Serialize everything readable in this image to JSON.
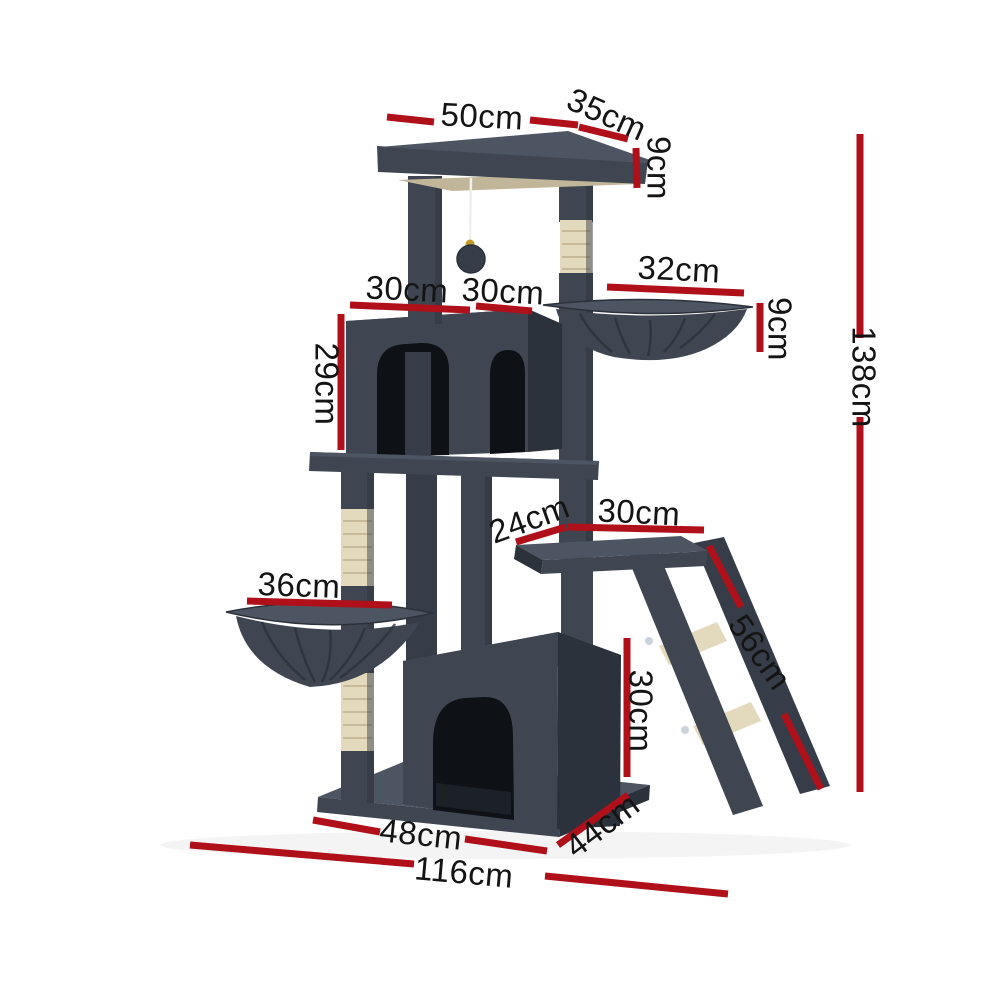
{
  "page": {
    "background": "#ffffff"
  },
  "annotations": {
    "color": "#b0101a",
    "text_color": "#141414",
    "dims": {
      "top_width": {
        "text": "50cm"
      },
      "top_depth": {
        "text": "35cm"
      },
      "top_thickness": {
        "text": "9cm"
      },
      "condo_width_left": {
        "text": "30cm"
      },
      "condo_width_right": {
        "text": "30cm"
      },
      "condo_height": {
        "text": "29cm"
      },
      "hammock_width": {
        "text": "32cm"
      },
      "hammock_depth": {
        "text": "9cm"
      },
      "total_height": {
        "text": "138cm"
      },
      "perch_inset": {
        "text": "24cm"
      },
      "perch_width": {
        "text": "30cm"
      },
      "ramp_length": {
        "text": "56cm"
      },
      "lower_hammock_width": {
        "text": "36cm"
      },
      "lower_condo_height": {
        "text": "30cm"
      },
      "base_width": {
        "text": "48cm"
      },
      "base_depth": {
        "text": "44cm"
      },
      "overall_width": {
        "text": "116cm"
      }
    }
  },
  "product": {
    "colors": {
      "plush_top": "#4d5562",
      "plush": "#3f4651",
      "plush_mid": "#363d48",
      "plush_side": "#2c323b",
      "opening": "#0e1116",
      "sisal": "#e3d9bd",
      "sisal_shade": "#c6ba9b",
      "underside": "#c2b69a",
      "string": "#efefec",
      "bell": "#c59a2a",
      "screw": "#ccd2d9"
    }
  }
}
